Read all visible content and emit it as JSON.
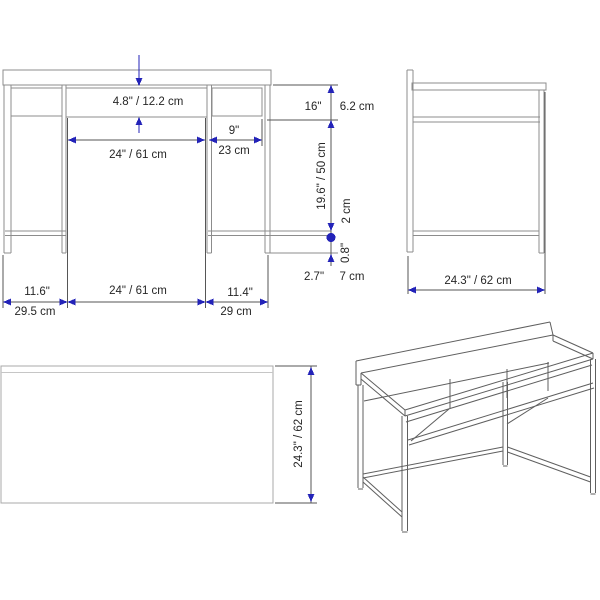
{
  "drawing": {
    "colors": {
      "dimension_accent": "#2323b8",
      "furniture_line": "#8c8c8c",
      "dimension_line": "#565656",
      "text": "#262626",
      "background": "#ffffff"
    },
    "views": {
      "front": {
        "dims": {
          "shelf_opening_height": "4.8\" / 12.2 cm",
          "middle_opening_width_top": "24\" / 61 cm",
          "right_opening_width_in": "9\"",
          "right_opening_width_cm": "23 cm",
          "top_section_height_in": "16\"",
          "top_section_height_cm": "6.2 cm",
          "leg_height": "19.6\" / 50 cm",
          "tube_thickness_cm": "2 cm",
          "tube_thickness_in": "0.8\"",
          "foot_clearance_in": "2.7\"",
          "foot_clearance_cm": "7 cm",
          "left_section_width_in": "11.6\"",
          "left_section_width_cm": "29.5 cm",
          "middle_section_width_bottom": "24\" / 61 cm",
          "right_section_width_in": "11.4\"",
          "right_section_width_cm": "29 cm"
        }
      },
      "side": {
        "dims": {
          "depth": "24.3\" / 62 cm"
        }
      },
      "top": {
        "dims": {
          "depth": "24.3\" / 62 cm"
        }
      }
    }
  }
}
